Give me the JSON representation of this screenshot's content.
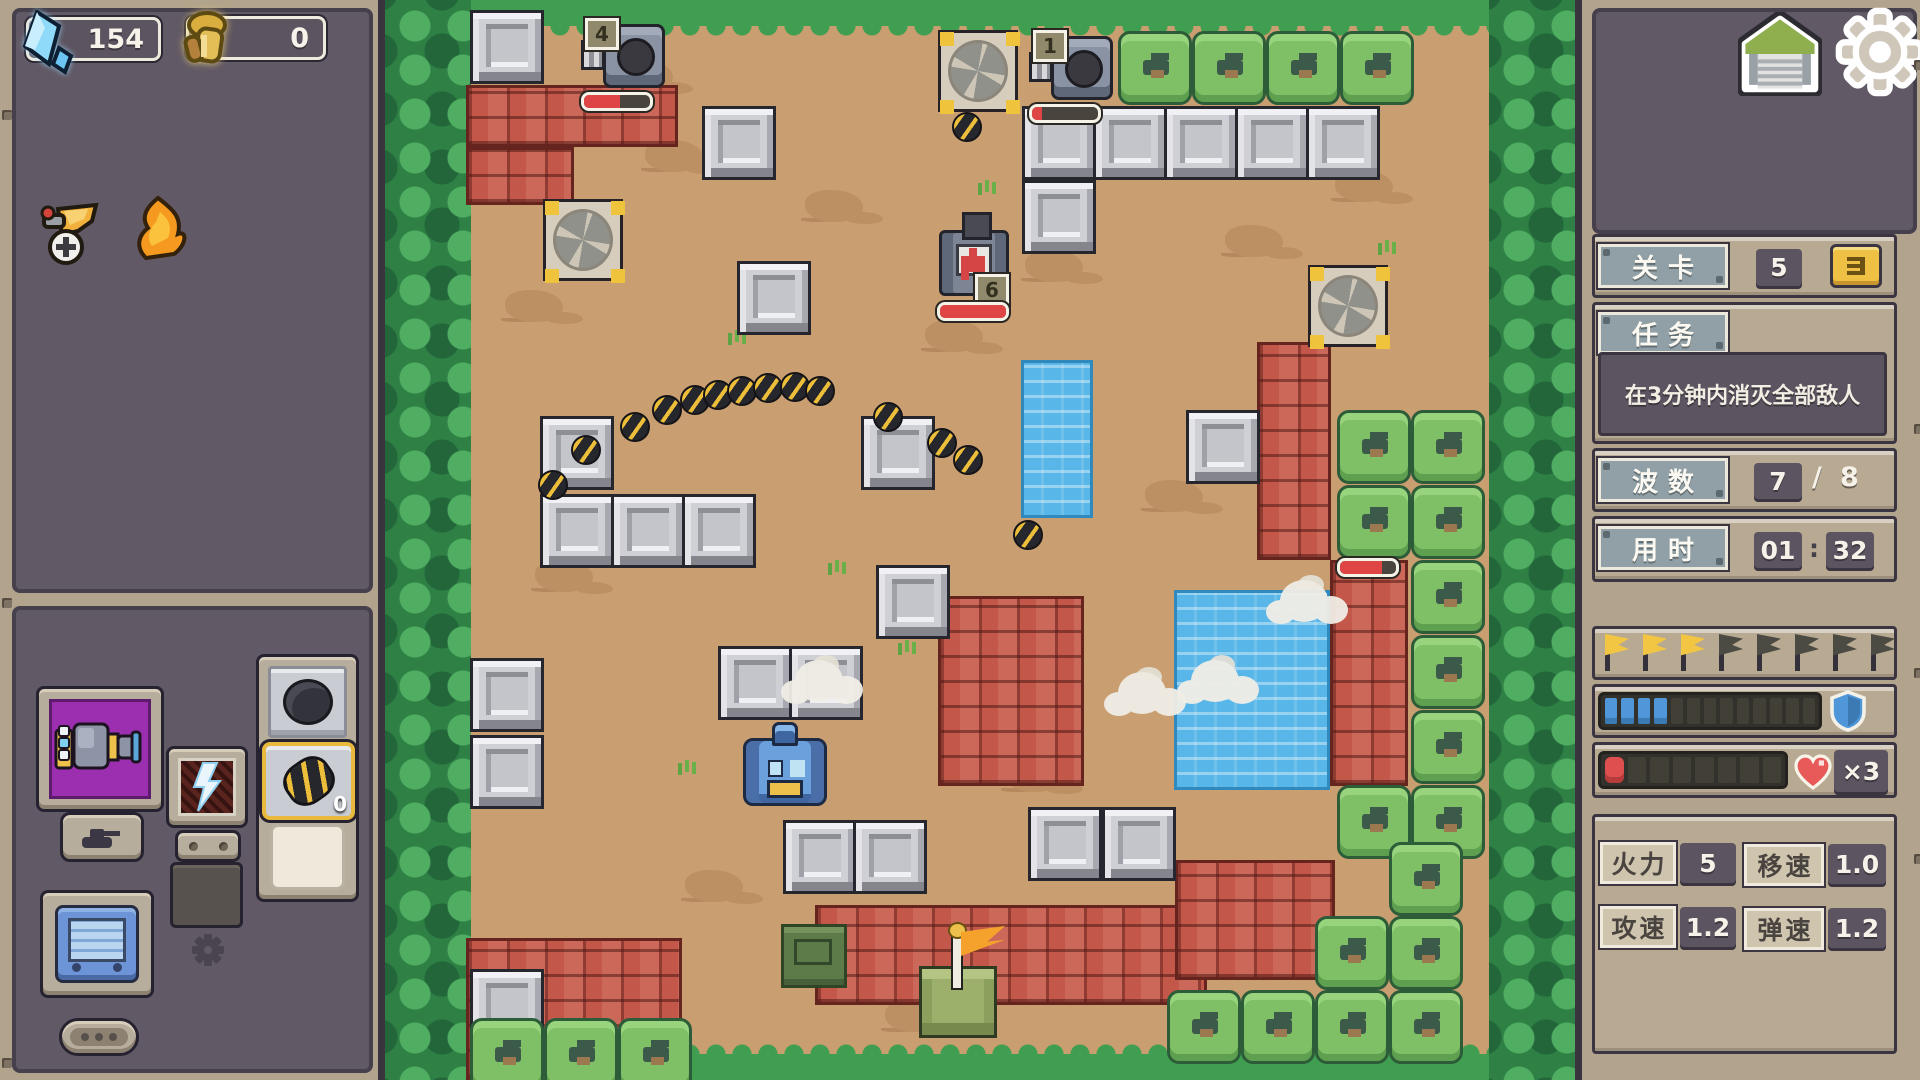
{
  "left": {
    "resources": [
      {
        "icon": "crystal-icon",
        "value": "154"
      },
      {
        "icon": "gold-icon",
        "value": "0"
      }
    ],
    "items": [
      {
        "icon": "winged-wheel-icon"
      },
      {
        "icon": "flame-icon"
      }
    ],
    "equipment": {
      "ammo_count": "0"
    }
  },
  "right": {
    "level": {
      "label": "关卡",
      "value": "5"
    },
    "mission": {
      "label": "任务",
      "text": "在3分钟内消灭全部敌人"
    },
    "wave": {
      "label": "波数",
      "current": "7",
      "separator": "/",
      "total": "8"
    },
    "time": {
      "label": "用时",
      "minutes": "01",
      "colon": ":",
      "seconds": "32"
    },
    "flags": {
      "total": 8,
      "gold": 3
    },
    "shield_bar": {
      "segments": 13,
      "filled": 4
    },
    "health_bar": {
      "segments": 8,
      "filled": 1,
      "lives": "×3"
    },
    "stats": [
      {
        "label": "火力",
        "value": "5"
      },
      {
        "label": "移速",
        "value": "1.0"
      },
      {
        "label": "攻速",
        "value": "1.2"
      },
      {
        "label": "弹速",
        "value": "1.2"
      }
    ]
  },
  "map": {
    "colors": {
      "dirt": "#c99e71",
      "grass": "#3f9e4f",
      "water": "#58b6e9",
      "brick": "#c2574a"
    },
    "stones": [
      [
        85,
        10
      ],
      [
        317,
        106
      ],
      [
        352,
        261
      ],
      [
        155,
        416
      ],
      [
        476,
        416
      ],
      [
        155,
        494
      ],
      [
        226,
        494
      ],
      [
        297,
        494
      ],
      [
        491,
        565
      ],
      [
        333,
        646
      ],
      [
        404,
        646
      ],
      [
        85,
        658
      ],
      [
        85,
        735
      ],
      [
        398,
        820
      ],
      [
        468,
        820
      ],
      [
        643,
        807
      ],
      [
        717,
        807
      ],
      [
        85,
        969
      ],
      [
        637,
        106
      ],
      [
        708,
        106
      ],
      [
        779,
        106
      ],
      [
        850,
        106
      ],
      [
        921,
        106
      ],
      [
        637,
        180
      ],
      [
        801,
        410
      ]
    ],
    "bricks": [
      [
        81,
        85,
        212,
        62
      ],
      [
        81,
        147,
        108,
        58
      ],
      [
        553,
        596,
        146,
        190
      ],
      [
        430,
        905,
        392,
        100
      ],
      [
        81,
        938,
        216,
        142
      ],
      [
        872,
        342,
        74,
        218
      ],
      [
        945,
        560,
        78,
        226
      ],
      [
        790,
        860,
        160,
        120
      ]
    ],
    "bushes": [
      [
        733,
        31
      ],
      [
        807,
        31
      ],
      [
        881,
        31
      ],
      [
        955,
        31
      ],
      [
        952,
        410
      ],
      [
        1026,
        410
      ],
      [
        952,
        485
      ],
      [
        1026,
        485
      ],
      [
        1026,
        560
      ],
      [
        1026,
        635
      ],
      [
        1026,
        710
      ],
      [
        952,
        785
      ],
      [
        1026,
        785
      ],
      [
        782,
        990
      ],
      [
        856,
        990
      ],
      [
        930,
        990
      ],
      [
        1004,
        990
      ],
      [
        1004,
        916
      ],
      [
        1004,
        842
      ],
      [
        930,
        916
      ],
      [
        85,
        1018
      ],
      [
        159,
        1018
      ],
      [
        233,
        1018
      ]
    ],
    "waters": [
      [
        636,
        360,
        72,
        158
      ],
      [
        789,
        590,
        156,
        200
      ]
    ],
    "fans": [
      [
        158,
        199
      ],
      [
        553,
        30
      ],
      [
        923,
        265
      ]
    ],
    "bombs": [
      [
        153,
        470
      ],
      [
        186,
        435
      ],
      [
        235,
        412
      ],
      [
        267,
        395
      ],
      [
        295,
        385
      ],
      [
        318,
        380
      ],
      [
        342,
        376
      ],
      [
        368,
        373
      ],
      [
        395,
        372
      ],
      [
        420,
        376
      ],
      [
        488,
        402
      ],
      [
        542,
        428
      ],
      [
        568,
        445
      ],
      [
        628,
        520
      ],
      [
        567,
        112
      ]
    ],
    "smoke": [
      [
        410,
        660
      ],
      [
        733,
        672
      ],
      [
        806,
        660
      ],
      [
        895,
        580
      ]
    ],
    "patches": [
      [
        120,
        290
      ],
      [
        260,
        140
      ],
      [
        640,
        250
      ],
      [
        540,
        320
      ],
      [
        840,
        225
      ],
      [
        300,
        870
      ],
      [
        620,
        760
      ],
      [
        150,
        560
      ],
      [
        950,
        170
      ],
      [
        500,
        1000
      ],
      [
        230,
        60
      ],
      [
        760,
        480
      ],
      [
        420,
        190
      ],
      [
        980,
        930
      ]
    ],
    "tufts": [
      [
        350,
        330
      ],
      [
        520,
        640
      ],
      [
        700,
        820
      ],
      [
        880,
        430
      ],
      [
        300,
        760
      ],
      [
        1000,
        240
      ],
      [
        600,
        180
      ],
      [
        450,
        560
      ]
    ],
    "units": [
      {
        "type": "turret",
        "x": 200,
        "y": 18,
        "badge": "4",
        "hp": 0.55
      },
      {
        "type": "turret",
        "x": 648,
        "y": 30,
        "badge": "1",
        "hp": 0.15
      },
      {
        "type": "medic",
        "x": 550,
        "y": 214,
        "badge": "6",
        "hp": 1
      },
      {
        "type": "blue",
        "x": 356,
        "y": 726
      },
      {
        "type": "base",
        "x": 532,
        "y": 938
      },
      {
        "type": "crate",
        "x": 396,
        "y": 924
      },
      {
        "type": "hpbar",
        "x": 952,
        "y": 558,
        "hp": 0.75
      }
    ]
  }
}
